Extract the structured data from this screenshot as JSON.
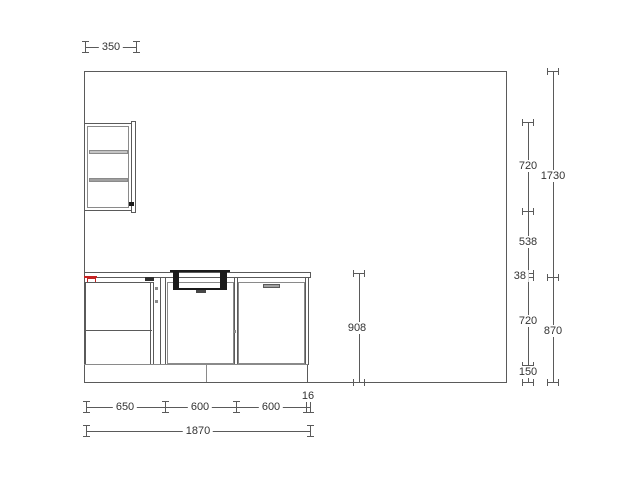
{
  "dimensions": {
    "wall_cabinet_width": "350",
    "right_inner": {
      "wall_cabinet_height": "720",
      "gap_below_wall_cabinet": "538",
      "worktop_thickness": "38",
      "base_cabinet_height": "720",
      "plinth_height": "150"
    },
    "right_outer": {
      "upper_total": "1730",
      "worktop_total": "870"
    },
    "worktop_to_floor": "908",
    "bottom_segments": [
      "650",
      "600",
      "600"
    ],
    "worktop_overhang": "16",
    "total_width": "1870"
  },
  "colors": {
    "background": "#ffffff",
    "line": "#5a5a5a",
    "line_light": "#8a8a8a",
    "line_dark": "#2e2e2e",
    "shelf_light": "#c4c4c4",
    "shelf_dark": "#a0a0a0",
    "sink": "#1a1a1a",
    "alert": "#c42222",
    "text": "#333333"
  }
}
